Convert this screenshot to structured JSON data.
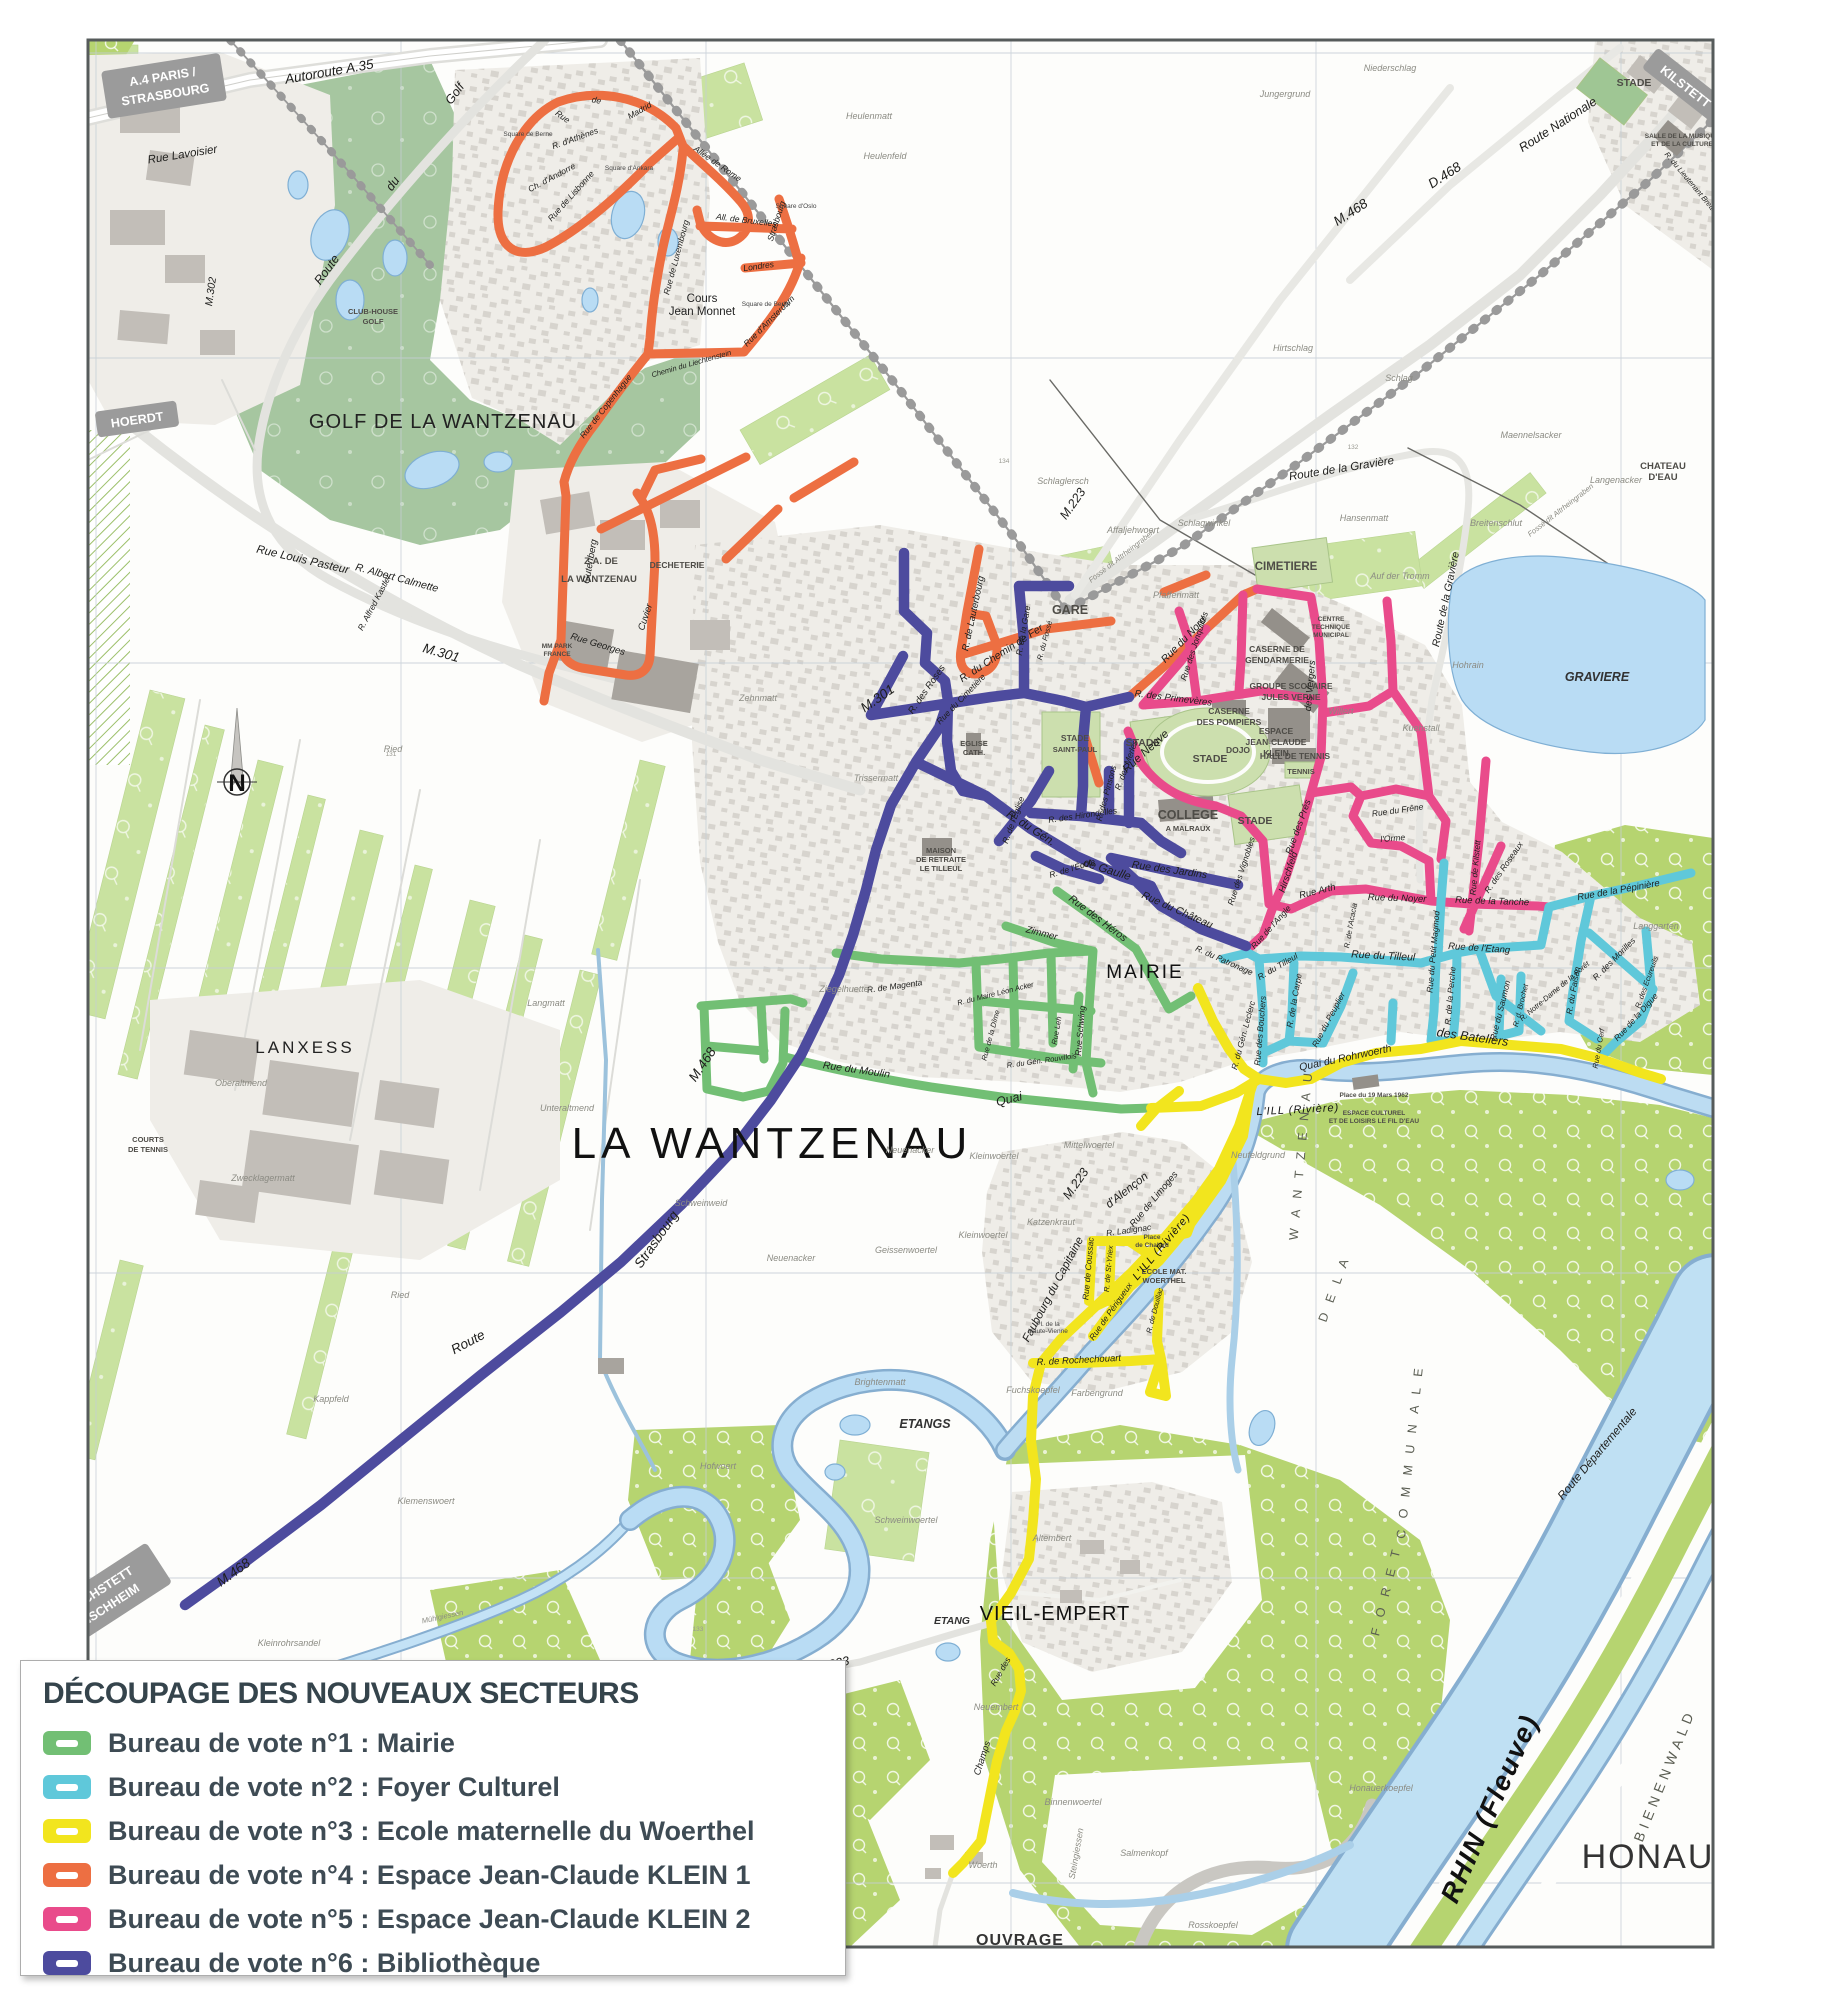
{
  "legend": {
    "title": "DÉCOUPAGE DES NOUVEAUX SECTEURS",
    "items": [
      {
        "label": "Bureau de vote n°1 : Mairie",
        "color": "#72bf74"
      },
      {
        "label": "Bureau de vote n°2 : Foyer Culturel",
        "color": "#5fc8da"
      },
      {
        "label": "Bureau de vote n°3 : Ecole maternelle du Woerthel",
        "color": "#f2e51e"
      },
      {
        "label": "Bureau de vote n°4 : Espace Jean-Claude KLEIN 1",
        "color": "#ed6f42"
      },
      {
        "label": "Bureau de vote n°5 : Espace Jean-Claude KLEIN 2",
        "color": "#e94b8b"
      },
      {
        "label": "Bureau de vote n°6 : Bibliothèque",
        "color": "#4d4b9e"
      }
    ]
  },
  "colors": {
    "water": "#b9dcf4",
    "rhine": "#bfe0f3",
    "forest": "#b6d470",
    "field": "#c9e2a0",
    "golf": "#a6c6a0",
    "urban": "#efede8",
    "sign": "#9b9b9b"
  },
  "map": {
    "north_label": "N",
    "signs": [
      {
        "line1": "A.4 PARIS /",
        "line2": "STRASBOURG"
      },
      {
        "line1": "HOERDT",
        "line2": ""
      },
      {
        "line1": "KILSTETT",
        "line2": ""
      },
      {
        "line1": "REICHSTETT",
        "line2": "BISCHHEIM"
      }
    ],
    "labels": [
      {
        "text": "LA WANTZENAU"
      },
      {
        "text": "GOLF DE LA WANTZENAU"
      },
      {
        "text": "LANXESS"
      },
      {
        "text": "HONAU"
      },
      {
        "text": "VIEIL-EMPERT"
      },
      {
        "text": "OUVRAGE"
      },
      {
        "text": "ETANGS"
      },
      {
        "text": "ETANG"
      },
      {
        "text": "GARE"
      },
      {
        "text": "CIMETIERE"
      },
      {
        "text": "CASERNE DE"
      },
      {
        "text": "GENDARMERIE"
      },
      {
        "text": "GROUPE SCOLAIRE"
      },
      {
        "text": "JULES VERNE"
      },
      {
        "text": "CASERNE"
      },
      {
        "text": "DES POMPIERS"
      },
      {
        "text": "ESPACE"
      },
      {
        "text": "JEAN-CLAUDE"
      },
      {
        "text": "KLEIN"
      },
      {
        "text": "DOJO"
      },
      {
        "text": "HALL DE TENNIS"
      },
      {
        "text": "TENNIS"
      },
      {
        "text": "STADE"
      },
      {
        "text": "STADE"
      },
      {
        "text": "STADE"
      },
      {
        "text": "STADE"
      },
      {
        "text": "STADE"
      },
      {
        "text": "SAINT-PAUL"
      },
      {
        "text": "COLLEGE"
      },
      {
        "text": "A MALRAUX"
      },
      {
        "text": "MAIRIE"
      },
      {
        "text": "EGLISE"
      },
      {
        "text": "CATH."
      },
      {
        "text": "MAISON"
      },
      {
        "text": "DE RETRAITE"
      },
      {
        "text": "LE TILLEUL"
      },
      {
        "text": "Z.A. DE"
      },
      {
        "text": "LA WANTZENAU"
      },
      {
        "text": "DECHETERIE"
      },
      {
        "text": "MM PARK"
      },
      {
        "text": "FRANCE"
      },
      {
        "text": "CLUB-HOUSE"
      },
      {
        "text": "GOLF"
      },
      {
        "text": "COURTS"
      },
      {
        "text": "DE TENNIS"
      },
      {
        "text": "CHATEAU"
      },
      {
        "text": "D'EAU"
      },
      {
        "text": "GRAVIERE"
      },
      {
        "text": "SALLE DE LA MUSIQUE"
      },
      {
        "text": "ET DE LA CULTURE"
      },
      {
        "text": "CENTRE"
      },
      {
        "text": "TECHNIQUE"
      },
      {
        "text": "MUNICIPAL"
      },
      {
        "text": "Cours"
      },
      {
        "text": "Jean Monnet"
      },
      {
        "text": "Place du 19 Mars 1962"
      },
      {
        "text": "ESPACE CULTUREL"
      },
      {
        "text": "ET DE LOISIRS LE FIL D'EAU"
      },
      {
        "text": "ECOLE MAT."
      },
      {
        "text": "WOERTHEL"
      },
      {
        "text": "Place"
      },
      {
        "text": "de Chalard"
      },
      {
        "text": "Autoroute A.35"
      },
      {
        "text": "Rue Lavoisier"
      },
      {
        "text": "M.302"
      },
      {
        "text": "Route"
      },
      {
        "text": "du"
      },
      {
        "text": "Golf"
      },
      {
        "text": "M.301"
      },
      {
        "text": "M.301"
      },
      {
        "text": "M.468"
      },
      {
        "text": "M.468"
      },
      {
        "text": "M.468"
      },
      {
        "text": "D.468"
      },
      {
        "text": "Route Nationale"
      },
      {
        "text": "Route"
      },
      {
        "text": "Strasbourg"
      },
      {
        "text": "M.223"
      },
      {
        "text": "M.223"
      },
      {
        "text": "M.223"
      },
      {
        "text": "Route de la Gravière"
      },
      {
        "text": "Route de la Gravière"
      },
      {
        "text": "Fossé dit Altrheingraben"
      },
      {
        "text": "Fossé dit Altrheingraben"
      },
      {
        "text": "Route Départementale"
      },
      {
        "text": "Rue Louis Pasteur"
      },
      {
        "text": "R. Albert Calmette"
      },
      {
        "text": "R. Alfred Kastler"
      },
      {
        "text": "Gutenberg"
      },
      {
        "text": "Rue Georges"
      },
      {
        "text": "Cuvier"
      },
      {
        "text": "Rue"
      },
      {
        "text": "de"
      },
      {
        "text": "Madrid"
      },
      {
        "text": "R. d'Athènes"
      },
      {
        "text": "Ch. d'Andorre"
      },
      {
        "text": "Rue de Lisbonne"
      },
      {
        "text": "Allée de Rome"
      },
      {
        "text": "All. de Bruxelles"
      },
      {
        "text": "Rue de Luxembourg"
      },
      {
        "text": "Strasbourg"
      },
      {
        "text": "Londres"
      },
      {
        "text": "Rue d'Amsterdam"
      },
      {
        "text": "Chemin du Liechtenstein"
      },
      {
        "text": "Rue de Copenhague"
      },
      {
        "text": "Square de Berne"
      },
      {
        "text": "Square d'Ankara"
      },
      {
        "text": "Square d'Oslo"
      },
      {
        "text": "Square de Berlin"
      },
      {
        "text": "R. de Lauterbourg"
      },
      {
        "text": "R. du Chemin de Fer"
      },
      {
        "text": "Rue du Nord"
      },
      {
        "text": "R. des Primevères"
      },
      {
        "text": "Rue des Jonquilles"
      },
      {
        "text": "Rue Neuve"
      },
      {
        "text": "des Vergers"
      },
      {
        "text": "Rue des Prés"
      },
      {
        "text": "Hirschfeld"
      },
      {
        "text": "Rue des Vignobles"
      },
      {
        "text": "Rue de l'Angle"
      },
      {
        "text": "Rue Arth"
      },
      {
        "text": "Rue du Noyer"
      },
      {
        "text": "Rue de la Tanche"
      },
      {
        "text": "Rue de Kilstett"
      },
      {
        "text": "R. des Roseaux"
      },
      {
        "text": "l'Orme"
      },
      {
        "text": "R. de l'Acacia"
      },
      {
        "text": "Rue du Frêne"
      },
      {
        "text": "Rue du Tilleul"
      },
      {
        "text": "R. du Tilleul"
      },
      {
        "text": "Rue du Peuplier"
      },
      {
        "text": "R. de la Carpe"
      },
      {
        "text": "Rue des Bouchers"
      },
      {
        "text": "Rue du Petit Magmod"
      },
      {
        "text": "R. de la Perche"
      },
      {
        "text": "Rue de l'Etang"
      },
      {
        "text": "Rue du Saumon"
      },
      {
        "text": "R. d. Brochet"
      },
      {
        "text": "R. Notre-Dame de la Forêt"
      },
      {
        "text": "Rue de la Pépinière"
      },
      {
        "text": "R. des Morilles"
      },
      {
        "text": "R. du Faisan"
      },
      {
        "text": "R. des Ecureuils"
      },
      {
        "text": "Rue de la Digue"
      },
      {
        "text": "Rue du Cerf"
      },
      {
        "text": "Langgarten"
      },
      {
        "text": "des Bateliers"
      },
      {
        "text": "Quai du Rohrwoerth"
      },
      {
        "text": "Quai"
      },
      {
        "text": "Rue du Moulin"
      },
      {
        "text": "R. du Maire Léon Acker"
      },
      {
        "text": "R. du Gén. Rouvillois"
      },
      {
        "text": "Rue de la Dîme"
      },
      {
        "text": "Rue des Héros"
      },
      {
        "text": "Zimmer"
      },
      {
        "text": "Rue Leh"
      },
      {
        "text": "Rue Schwing"
      },
      {
        "text": "R. de Magenta"
      },
      {
        "text": "R. des Roses"
      },
      {
        "text": "Rue du Cimetière"
      },
      {
        "text": "R. de la Gare"
      },
      {
        "text": "R. du Fossé"
      },
      {
        "text": "R. du Gén."
      },
      {
        "text": "de Gaulle"
      },
      {
        "text": "R. de l'Église"
      },
      {
        "text": "R. de l'École"
      },
      {
        "text": "Rue des Jardins"
      },
      {
        "text": "Rue du Château"
      },
      {
        "text": "R. des Hirondelles"
      },
      {
        "text": "R. des Pinsons"
      },
      {
        "text": "R. des Merles"
      },
      {
        "text": "R. du Patronage"
      },
      {
        "text": "R. du Gén. Leclerc"
      },
      {
        "text": "Faubourg du Capitaine"
      },
      {
        "text": "d'Alençon"
      },
      {
        "text": "Rue de Limoges"
      },
      {
        "text": "R. Ladignac"
      },
      {
        "text": "Rue de Coussac"
      },
      {
        "text": "R. de St-Yriex"
      },
      {
        "text": "Rue de Périgueux"
      },
      {
        "text": "R. de Douillac"
      },
      {
        "text": "R. de Rochechouart"
      },
      {
        "text": "Pl. de la"
      },
      {
        "text": "Haute-Vienne"
      },
      {
        "text": "Rue des"
      },
      {
        "text": "Champs"
      },
      {
        "text": "L'ILL (Rivière)"
      },
      {
        "text": "L'ILL (Rivière)"
      },
      {
        "text": "Mühlgiessen"
      },
      {
        "text": "RHIN (Fleuve)"
      },
      {
        "text": "BIENENWALD"
      },
      {
        "text": "F O R E T"
      },
      {
        "text": "C O M M U N A L E"
      },
      {
        "text": "D E  L A"
      },
      {
        "text": "W A N T Z E N A U"
      },
      {
        "text": "Trissermatt"
      },
      {
        "text": "Zehnmatt"
      },
      {
        "text": "Heulenmatt"
      },
      {
        "text": "Heulenfeld"
      },
      {
        "text": "Niederschlag"
      },
      {
        "text": "Jungergrund"
      },
      {
        "text": "Hirtschlag"
      },
      {
        "text": "Schlag"
      },
      {
        "text": "Schlaglersch"
      },
      {
        "text": "Schlagwinkel"
      },
      {
        "text": "Pfaffenmatt"
      },
      {
        "text": "Affaljehwoert"
      },
      {
        "text": "Hansenmatt"
      },
      {
        "text": "Auf der Tromm"
      },
      {
        "text": "Maennelsacker"
      },
      {
        "text": "Langenacker"
      },
      {
        "text": "Breitenschlut"
      },
      {
        "text": "Hohrain"
      },
      {
        "text": "Kuehstall"
      },
      {
        "text": "Willert"
      },
      {
        "text": "Unteraltmend"
      },
      {
        "text": "Oberaltmend"
      },
      {
        "text": "Schweinweid"
      },
      {
        "text": "Neuenacker"
      },
      {
        "text": "Neuenacker"
      },
      {
        "text": "Ziegelhuette"
      },
      {
        "text": "Kleinwoertel"
      },
      {
        "text": "Kleinwoertel"
      },
      {
        "text": "Mittelwoertel"
      },
      {
        "text": "Katzenkraut"
      },
      {
        "text": "Geissenwoertel"
      },
      {
        "text": "Brightenmatt"
      },
      {
        "text": "Fuchskoepfel"
      },
      {
        "text": "Farbengrund"
      },
      {
        "text": "Neufeldgrund"
      },
      {
        "text": "Altembert"
      },
      {
        "text": "Neuembert"
      },
      {
        "text": "Woerth"
      },
      {
        "text": "Binnenwoertel"
      },
      {
        "text": "Salmenkopf"
      },
      {
        "text": "Steingiessen"
      },
      {
        "text": "Rosskoepfel"
      },
      {
        "text": "Honauerkoepfel"
      },
      {
        "text": "Kleinrohrsandel"
      },
      {
        "text": "Hofwoert"
      },
      {
        "text": "Kappfeld"
      },
      {
        "text": "Klemenswoert"
      },
      {
        "text": "Ried"
      },
      {
        "text": "Ried"
      },
      {
        "text": "Langmatt"
      },
      {
        "text": "Zwecklagermatt"
      },
      {
        "text": "Schweinwoertel"
      },
      {
        "text": "R. du Lieutenant Brettignies"
      },
      {
        "text": "131"
      },
      {
        "text": "132"
      },
      {
        "text": "133"
      },
      {
        "text": "134"
      }
    ]
  }
}
